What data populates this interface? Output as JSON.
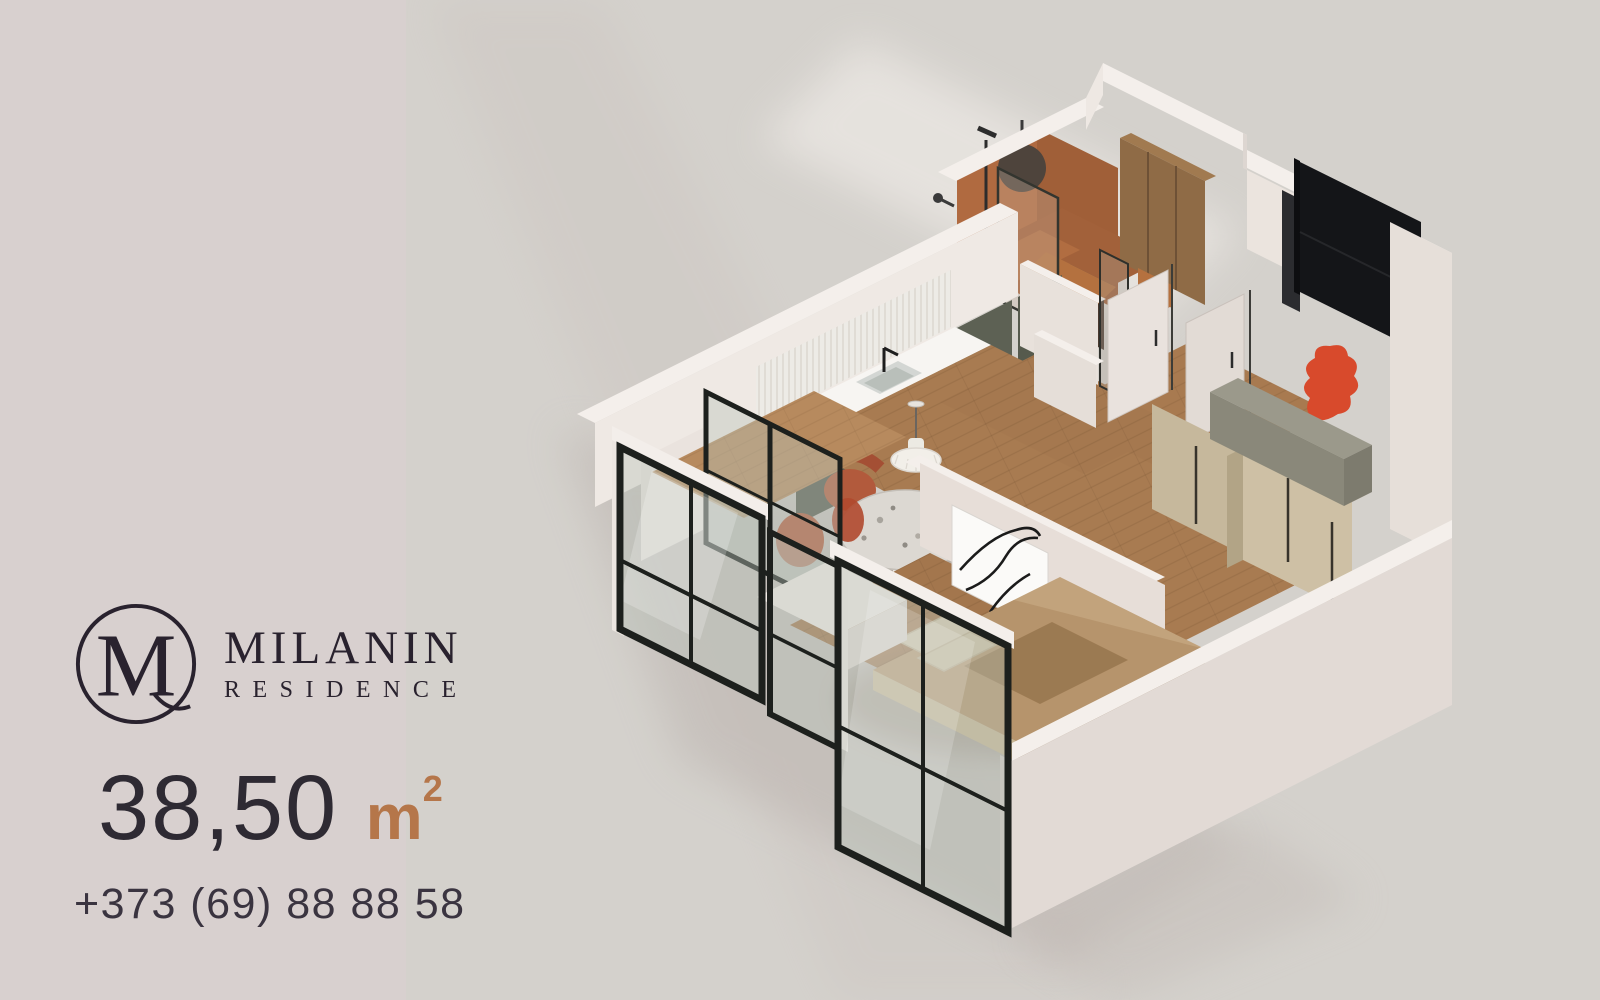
{
  "brand": {
    "monogram": "M",
    "name": "MILANIN",
    "subname": "RESIDENCE"
  },
  "listing": {
    "area": "38,50",
    "unit_base": "m",
    "unit_exponent": "2",
    "phone": "+373 (69) 88 88 58"
  },
  "floorplan": {
    "style": "isometric-3d-render",
    "rooms": [
      {
        "name": "balcony"
      },
      {
        "name": "kitchen"
      },
      {
        "name": "dining-area"
      },
      {
        "name": "bathroom"
      },
      {
        "name": "hallway"
      },
      {
        "name": "entry"
      },
      {
        "name": "bedroom"
      }
    ],
    "features": [
      "black-frame-panoramic-windows",
      "terracotta-tiled-bathroom",
      "olive-green-kitchen-cabinets",
      "round-terrazzo-dining-table",
      "white-pendant-lamp",
      "abstract-line-artwork",
      "double-bed",
      "light-wood-wardrobes",
      "black-entrance-door",
      "red-accent-decor",
      "oak-parquet-floor"
    ]
  },
  "palette": {
    "bg_left": "#d8d0cf",
    "bg_right": "#d4d1cc",
    "text_dark": "#29222e",
    "text_number": "#2e2a33",
    "text_phone": "#3a3440",
    "accent_copper": "#b5764a",
    "wall_top": "#f4efeb",
    "wall_light": "#e9e2dd",
    "wall_shade": "#dcd4cf",
    "terracotta": "#a05f38",
    "olive": "#5d6154",
    "wood_floor": "#a87b51",
    "wood_light": "#b78a5e",
    "wood_wardrobe": "#cec0a5",
    "wood_panel": "#8f6b46",
    "frame_black": "#1d201d",
    "door_black": "#141518",
    "red_accent": "#d84a2c",
    "sage": "#9b998b",
    "counter_white": "#f7f5f2",
    "art_white": "#fbfaf8",
    "bed_tan": "#c2a37c",
    "bed_throw": "#9b7a52",
    "pillow": "#d6c9ae",
    "table_terrazzo": "#dcd8d2",
    "chair_terracotta": "#b25a3c"
  }
}
